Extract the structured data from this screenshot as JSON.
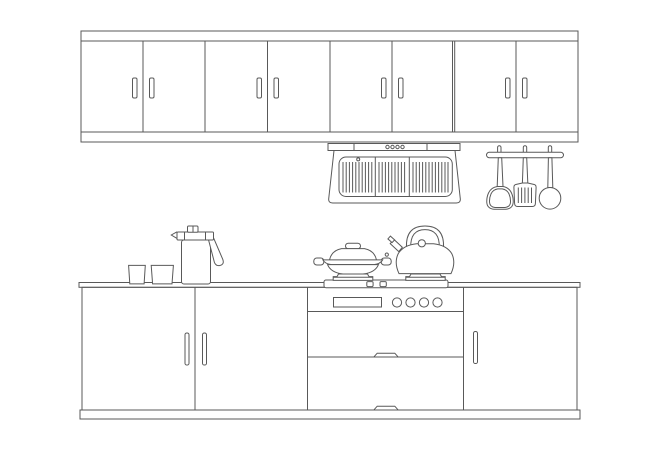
{
  "canvas": {
    "width": 650,
    "height": 459
  },
  "colors": {
    "background": "#ffffff",
    "line": "#595959"
  },
  "scene": {
    "description": "Line-art elevation drawing of a kitchen wall unit",
    "upper_cabinets": {
      "door_count": 8,
      "handle_count": 8,
      "sections": 4
    },
    "range_hood": {
      "vent_dot_count": 4,
      "filter_sections": 3
    },
    "utensil_rack": {
      "hook_count": 3,
      "utensils": [
        "wok-spatula",
        "slotted-turner",
        "ladle"
      ]
    },
    "countertop_items": {
      "cup_count": 2,
      "pitcher_count": 1
    },
    "cooktop": {
      "burner_count": 2,
      "control_count": 2,
      "cookware": [
        "lidded-wok",
        "kettle"
      ]
    },
    "oven": {
      "display_count": 1,
      "knob_count": 4,
      "drawer_count": 2
    },
    "base_cabinets": {
      "door_count": 3,
      "handle_count": 3
    }
  }
}
